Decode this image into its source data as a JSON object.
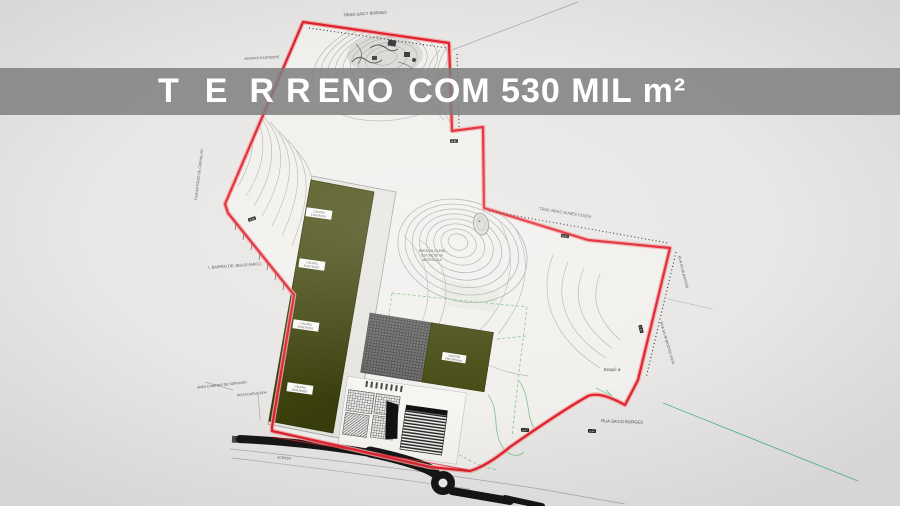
{
  "banner": {
    "full_text": "TERRENO COM 530 MIL m²",
    "spaced_letters": [
      "T",
      "E",
      "R",
      "R"
    ],
    "tight_letters": "ENO",
    "rest_text": "COM 530 MIL m²",
    "area_value": "530 MIL m²",
    "bg_color": "#808080",
    "text_color": "#ffffff"
  },
  "map": {
    "type": "cadastral-site-plan",
    "colors": {
      "boundary": "#df2230",
      "boundary_halo": "#f2a39f",
      "warehouse_fill": "#464b12",
      "hatched_building": "#6e6e6e",
      "contour": "#b2b2b2",
      "road": "#161616",
      "green_guides": "#8bc796",
      "teal_guide": "#57b9a0",
      "background": "#e8e7e5"
    },
    "labels": {
      "street_top": "TRINO SAICY BORGES",
      "street_left_vertical": "RUA ANTONIO DE CARVALHO",
      "acervo_top": "ACERVO EXISTENTE",
      "bairro_left": "I. BAIRRO DE JESUS AMICO",
      "servidao": "ÁREA CAMINHO DE SERVIDÃO",
      "pista": "PISTA DUPLICADA",
      "trav_ne_diagonal": "TRAV. BRAZ NUNES COSTA",
      "rua_right_upper": "RUA SILVA BASTOS",
      "rua_right_lower": "RUA SILVA BASTOS VISTA",
      "seapo": "Seapó ø",
      "rua_bottom_right": "RUA SAICO BORGES",
      "acesso_road": "ACESSO",
      "gleba_line1": "ÁREA DA GLEBA",
      "gleba_line2": "530.000,00 m²",
      "gleba_line3": "MATRÍCULA"
    },
    "warehouse_label": {
      "line1": "GALPÃO",
      "line2": "EXISTENTE"
    },
    "mid_building_label": {
      "line1": "GALPÃO",
      "line2": "PROJETADO"
    },
    "station_chips": [
      "E-01",
      "E-02",
      "E-03",
      "E-04",
      "E-05",
      "E-06"
    ]
  }
}
